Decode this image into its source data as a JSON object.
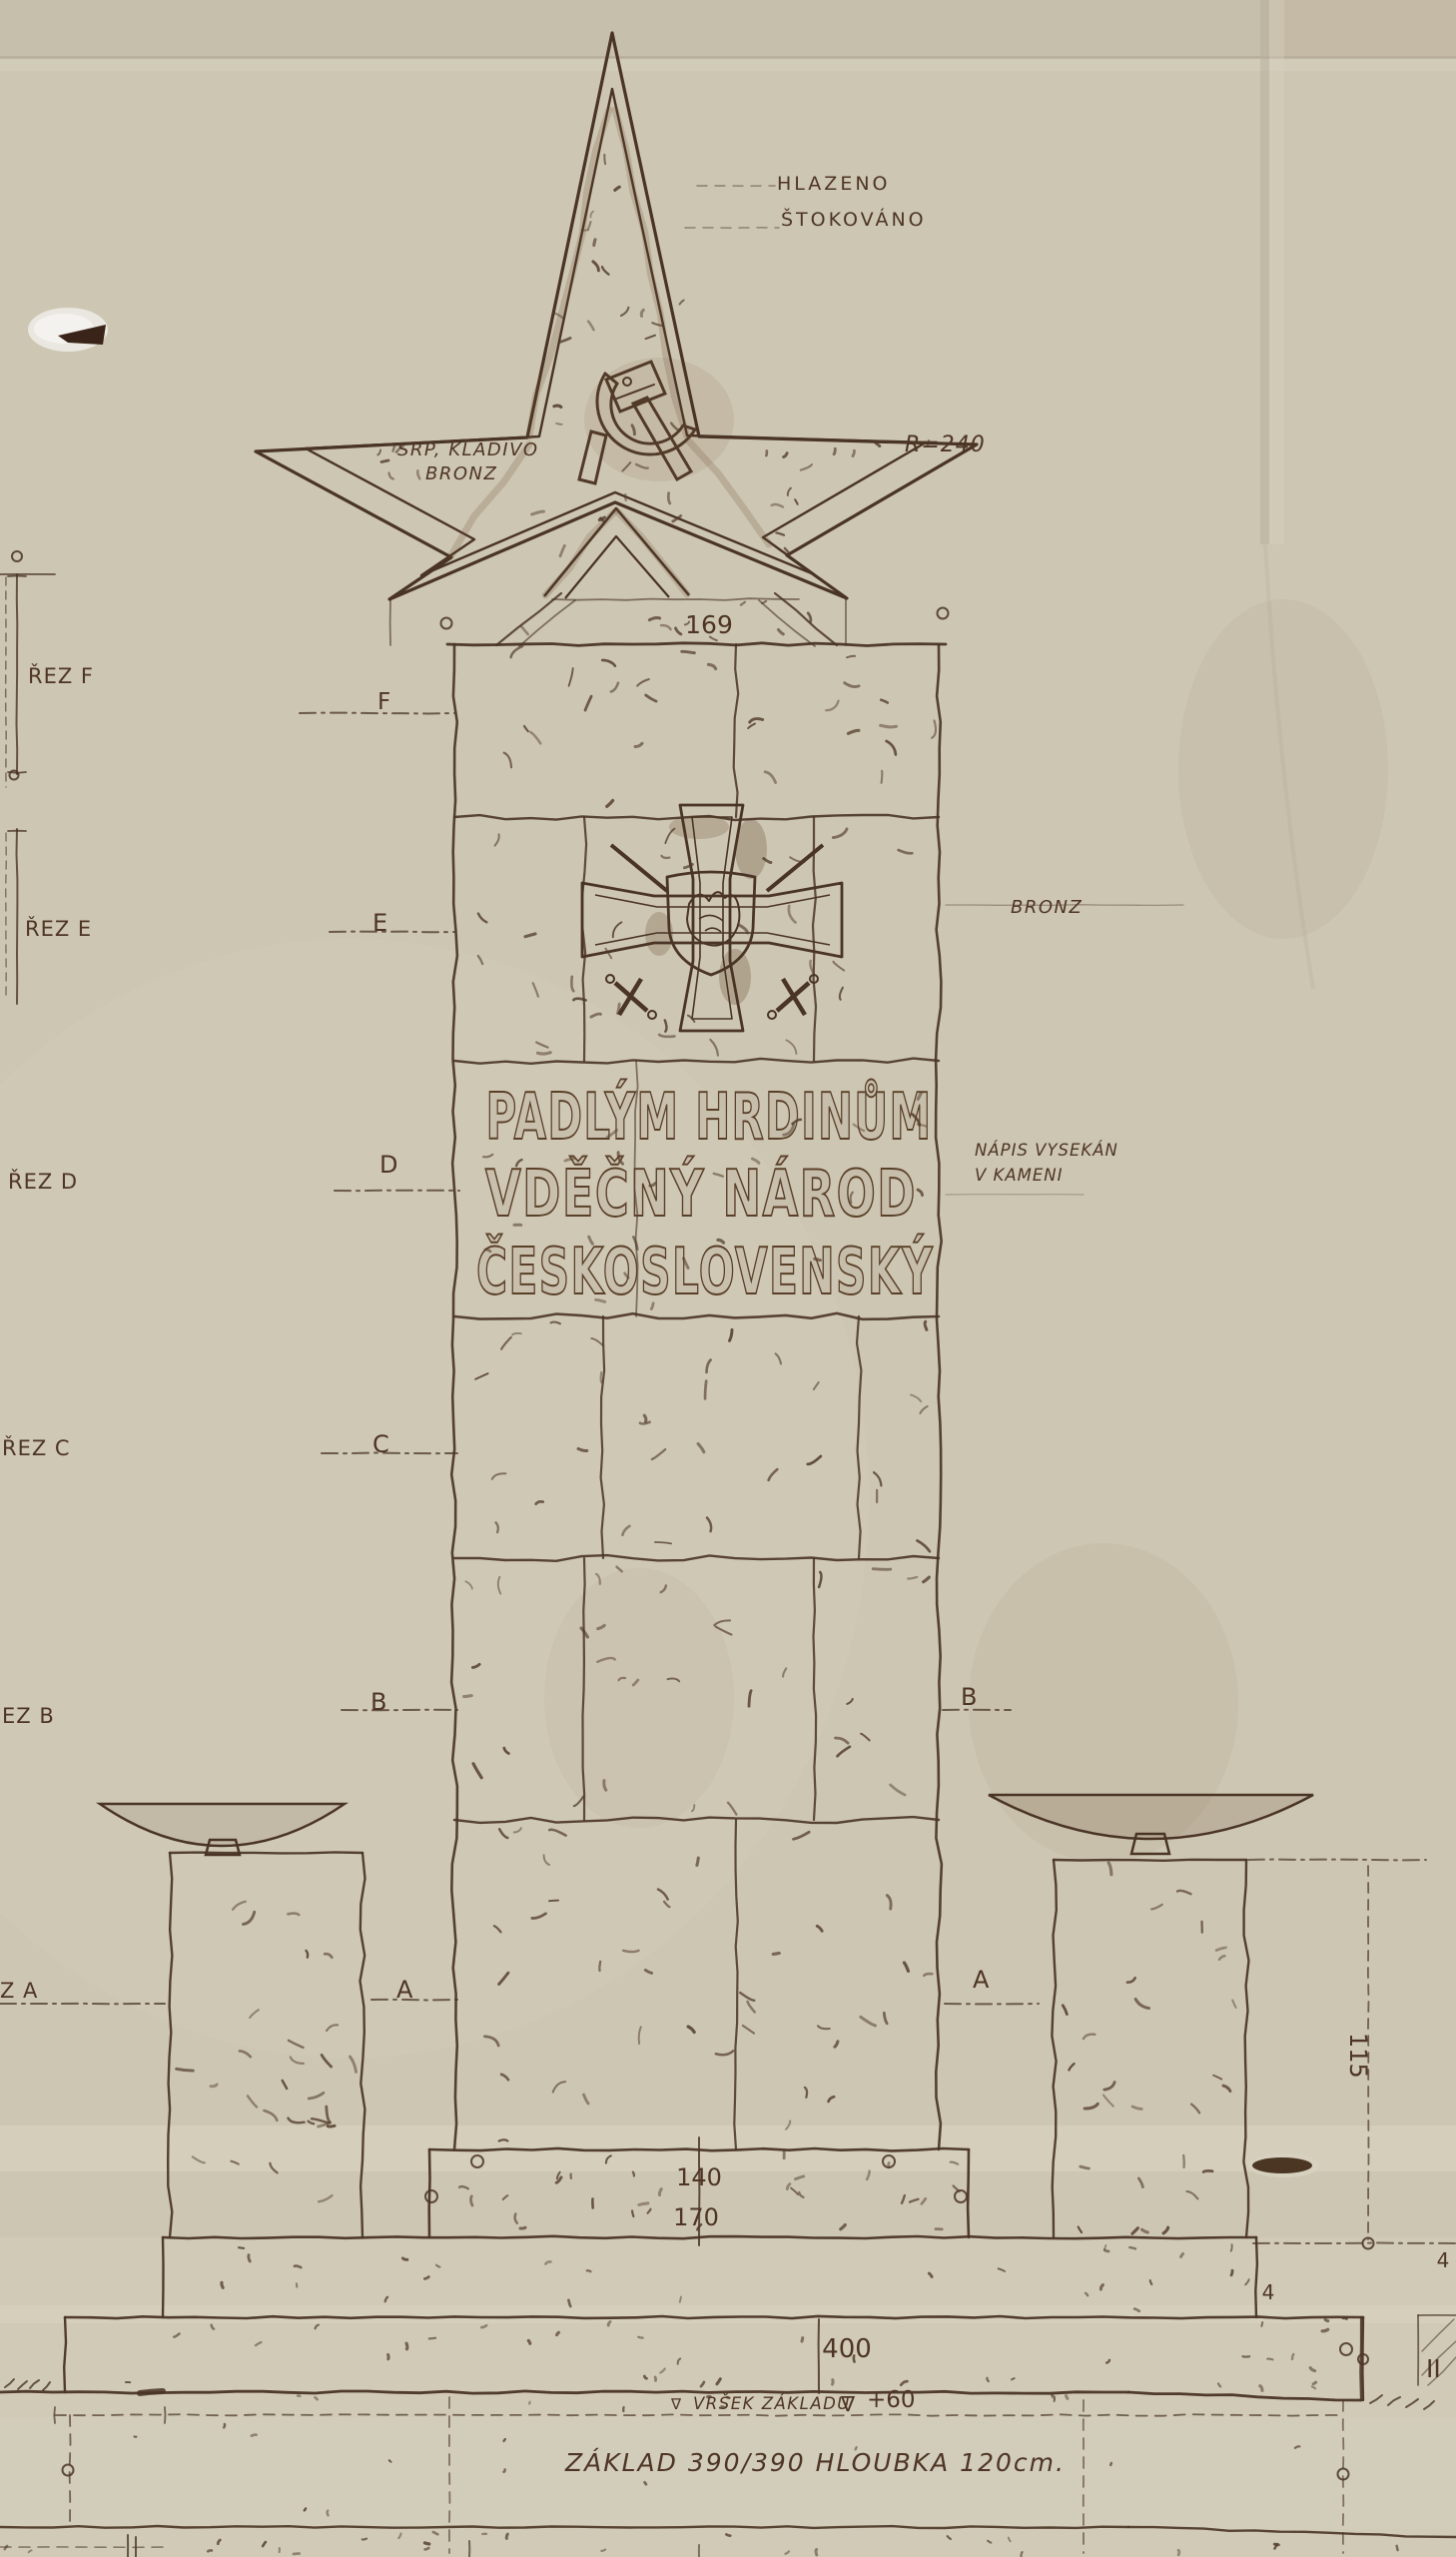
{
  "drawing": {
    "star": {
      "finish_note": [
        "HLAZENO",
        "ŠTOKOVÁNO"
      ],
      "material_note": [
        "SRP, KLADIVO",
        "BRONZ"
      ],
      "radius_dim": "R=240"
    },
    "shaft": {
      "top_width_dim": "169",
      "emblem_material": "BRONZ",
      "inscription_note": [
        "NÁPIS VYSEKÁN",
        "V KAMENI"
      ],
      "inscription": [
        "PADLÝM HRDINŮM",
        "VDĚČNÝ NÁROD",
        "ČESKOSLOVENSKÝ"
      ]
    },
    "section_labels": {
      "left_margin": [
        "ŘEZ F",
        "ŘEZ E",
        "ŘEZ D",
        "ŘEZ C",
        "EZ B",
        "Z A"
      ],
      "shaft_left": [
        "F",
        "E",
        "D",
        "C",
        "B",
        "A"
      ],
      "shaft_right": [
        "B",
        "A"
      ]
    },
    "dimensions": {
      "plinth_top": "140",
      "plinth_bottom": "170",
      "base": "400",
      "lip_left": "4",
      "lip_right": "4",
      "pier_height": "115",
      "ground_symbol": "∇"
    },
    "notes": {
      "foundation_top": "VRŠEK ZÁKLADU",
      "foundation_level": "+60",
      "foundation": "ZÁKLAD 390/390 HLOUBKA 120cm.",
      "detail_mark": "II"
    }
  }
}
